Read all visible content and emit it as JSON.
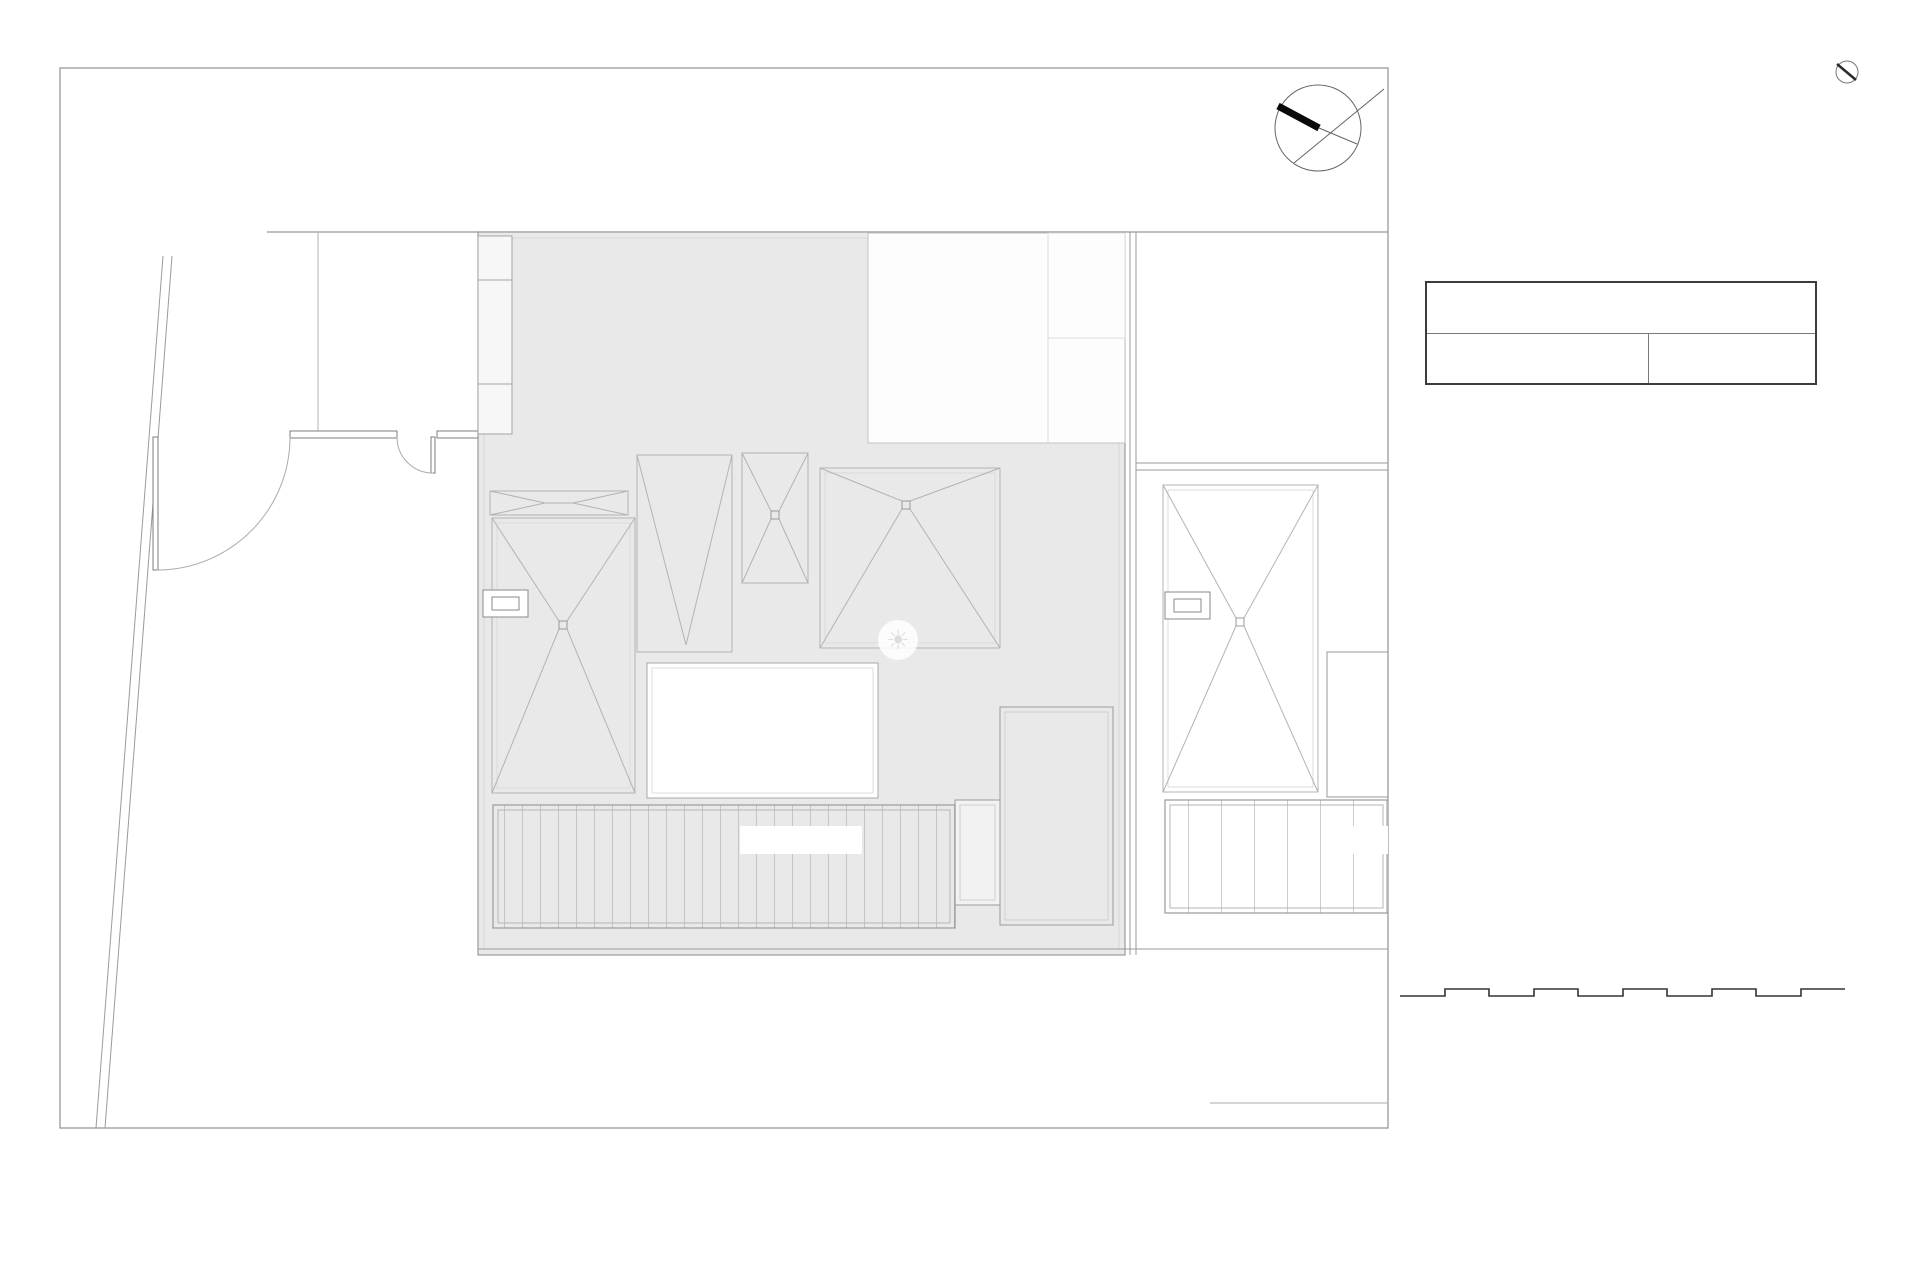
{
  "plan": {
    "parcel_title": "PARCELA 1",
    "parcel_area": "250.36",
    "band_label": "PARCELA 1",
    "right_band_label": "PARC",
    "frame_scale_label": "Escala Grafica 1/100",
    "parcel_fill_color": "#e9e9e9"
  },
  "watermark": {
    "icon": "sun-icon",
    "line1": "Overseas",
    "line2": "Property Market"
  },
  "table": {
    "title": "SUPERFICIES PARCELAS",
    "column_header": "PARCELA",
    "highlight_color": "#b5372a",
    "rows": [
      {
        "label": "Vivienda 01",
        "value": "250.36",
        "highlighted": true
      },
      {
        "label": "Vivienda 02",
        "value": "287.77"
      },
      {
        "label": "Vivienda 03",
        "value": "271.36"
      },
      {
        "label": "Vivienda 04",
        "value": "287.99"
      },
      {
        "label": "Vivienda 05",
        "value": "271.36"
      },
      {
        "label": "Vivienda 06",
        "value": "343.88"
      },
      {
        "label": "Vivienda 07",
        "value": "459.43"
      },
      {
        "label": "Vivienda 08",
        "value": "459.43"
      },
      {
        "label": "Vivienda 09",
        "value": "326.24"
      },
      {
        "label": "Vivienda 10",
        "value": "402.52"
      },
      {
        "label": "TOTAL",
        "value": "3360.34"
      }
    ]
  },
  "scalebar": {
    "label": "Escala Grafica 1/100"
  }
}
